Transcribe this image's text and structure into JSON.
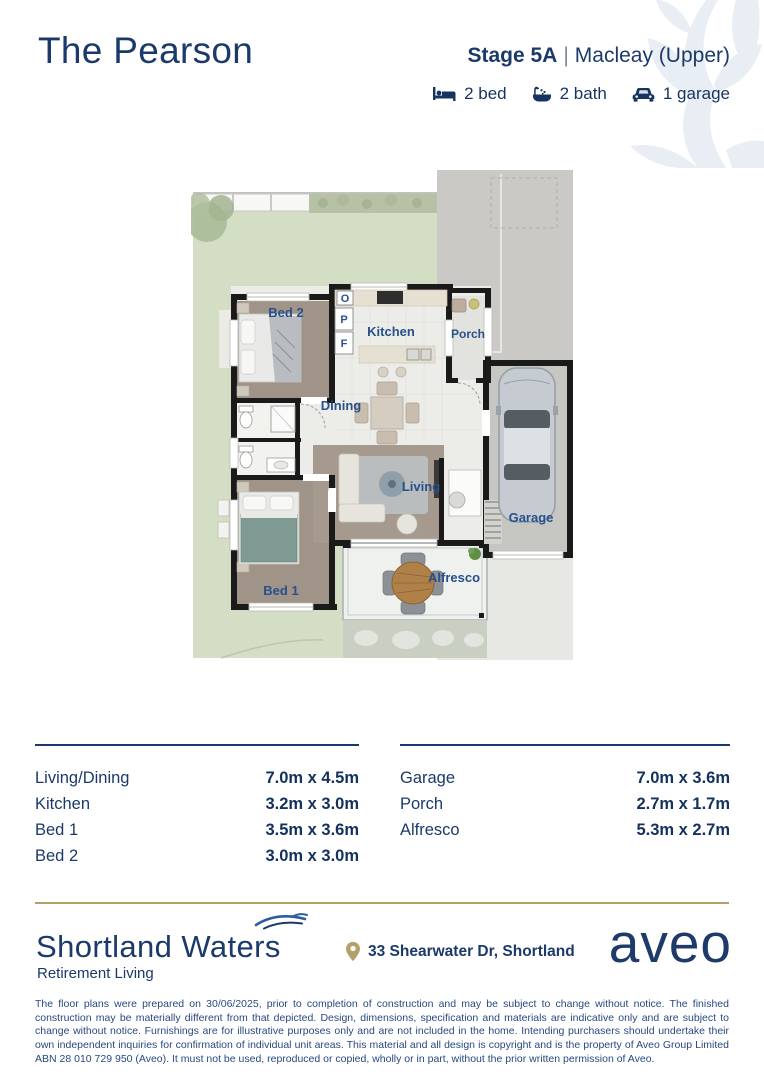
{
  "header": {
    "title": "The Pearson",
    "stage": "Stage 5A",
    "separator": "|",
    "variant": "Macleay (Upper)",
    "features": [
      {
        "icon": "bed-icon",
        "label": "2 bed"
      },
      {
        "icon": "bath-icon",
        "label": "2 bath"
      },
      {
        "icon": "car-icon",
        "label": "1 garage"
      }
    ]
  },
  "floorplan": {
    "labels": {
      "bed2": "Bed 2",
      "kitchen": "Kitchen",
      "porch": "Porch",
      "dining": "Dining",
      "living": "Living",
      "garage": "Garage",
      "bed1": "Bed 1",
      "alfresco": "Alfresco",
      "oven": "O",
      "pantry": "P",
      "fridge": "F"
    }
  },
  "dimensions": {
    "left": [
      {
        "room": "Living/Dining",
        "size": "7.0m x 4.5m"
      },
      {
        "room": "Kitchen",
        "size": "3.2m x 3.0m"
      },
      {
        "room": "Bed 1",
        "size": "3.5m x 3.6m"
      },
      {
        "room": "Bed 2",
        "size": "3.0m x 3.0m"
      }
    ],
    "right": [
      {
        "room": "Garage",
        "size": "7.0m x 3.6m"
      },
      {
        "room": "Porch",
        "size": "2.7m x 1.7m"
      },
      {
        "room": "Alfresco",
        "size": "5.3m x 2.7m"
      }
    ]
  },
  "footer": {
    "brand": "Shortland Waters",
    "brand_sub": "Retirement Living",
    "address": "33 Shearwater Dr, Shortland",
    "logo": "aveo",
    "disclaimer": "The floor plans were prepared on 30/06/2025, prior to completion of construction and may be subject to change without notice. The finished construction may be materially different from that depicted. Design, dimensions, specification and materials are indicative only and are subject to change without notice. Furnishings are for illustrative purposes only and are not included in the home. Intending purchasers should undertake their own independent inquiries for confirmation of individual unit areas. This material and all design is copyright and is the property of Aveo Group Limited ABN 28 010 729 950 (Aveo). It must not be used, reproduced or copied, wholly or in part, without the prior written permission of Aveo."
  },
  "colors": {
    "navy": "#1b3a6b",
    "label_blue": "#27508c",
    "gold": "#b3a06b",
    "lawn": "#d3dec5",
    "driveway": "#cac9c5",
    "carpet": "#a09488",
    "wall": "#1a1a1a",
    "watermark": "#e9edf4"
  }
}
